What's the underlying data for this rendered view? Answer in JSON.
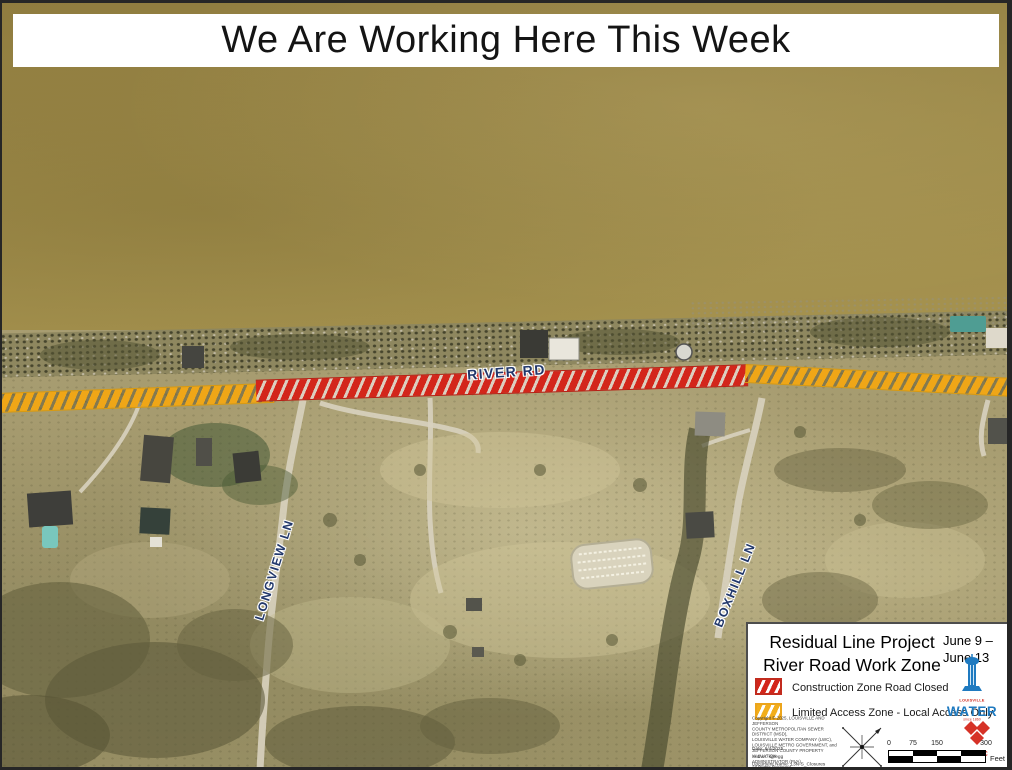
{
  "banner": {
    "text": "We Are Working Here This Week"
  },
  "map": {
    "labels": {
      "river_rd": "RIVER RD",
      "longview_ln": "LONGVIEW LN",
      "boxhill_ln": "BOXHILL LN"
    },
    "zone_colors": {
      "construction_closed": "#d3261b",
      "limited_access": "#efa617"
    }
  },
  "legend": {
    "title_line1": "Residual Line Project",
    "title_line2": "River Road Work Zone",
    "date_line1": "June 9 –",
    "date_line2": "June 13",
    "items": [
      {
        "label": "Construction Zone Road Closed",
        "color": "#d3261b"
      },
      {
        "label": "Limited Access Zone - Local Access Only",
        "color": "#efa617"
      }
    ],
    "copyright_lines": [
      "Copyright © 2025, LOUISVILLE AND JEFFERSON",
      "COUNTY METROPOLITAN SEWER DISTRICT (MSD),",
      "LOUISVILLE WATER COMPANY (LWC),",
      "LOUISVILLE METRO GOVERNMENT, and",
      "JEFFERSON COUNTY PROPERTY VALUATION",
      "ADMINISTRATOR (PVA).",
      "All Rights Reserved."
    ],
    "meta_lines": [
      "Date: 6/4/2025",
      "Author: kgregg",
      "Document Name: 13N-S_Closures"
    ],
    "scale_bar": {
      "ticks": [
        "0",
        "75",
        "150",
        "300"
      ],
      "unit": "Feet"
    },
    "logos": {
      "water_line1": "LOUISVILLE",
      "water_line2": "WATER",
      "water_sub": "since 1860",
      "lojic": "LOJIC"
    }
  }
}
